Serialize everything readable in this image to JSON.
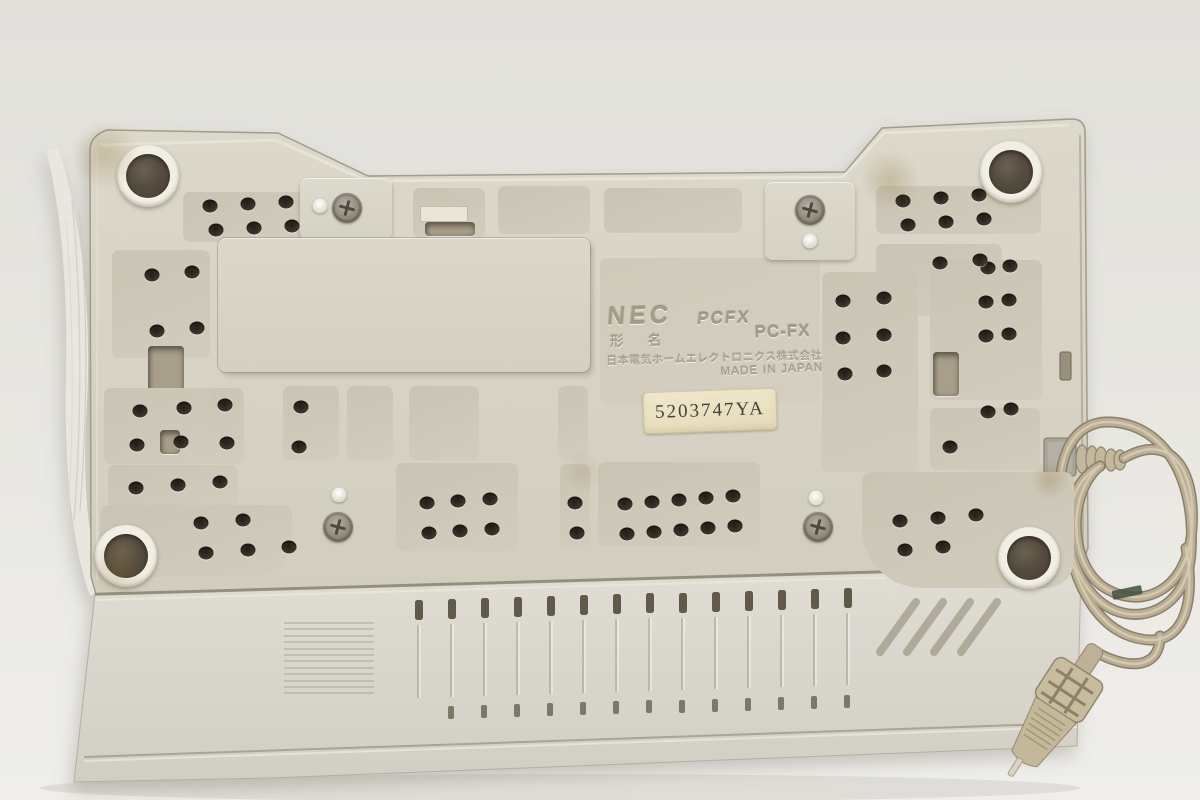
{
  "image": {
    "subject": "Underside of a beige NEC PC-FX game console with coiled power cord"
  },
  "markings": {
    "brand": "NEC",
    "logo_model": "PCFX",
    "model_label": "形 名",
    "model_number": "PC-FX",
    "manufacturer_line": "日本電気ホームエレクトロニクス株式会社",
    "origin_line": "MADE IN JAPAN"
  },
  "serial_label": {
    "text": "5203747YA"
  },
  "colors": {
    "background": "#e5e4df",
    "plastic_base": "#d6d2c5",
    "recess": "#ccc7b8",
    "rubber_foot": "#544c3e",
    "vent_hole": "#38322a",
    "power_cord": "#b6aa90",
    "serial_sticker": "#ece3c6"
  }
}
